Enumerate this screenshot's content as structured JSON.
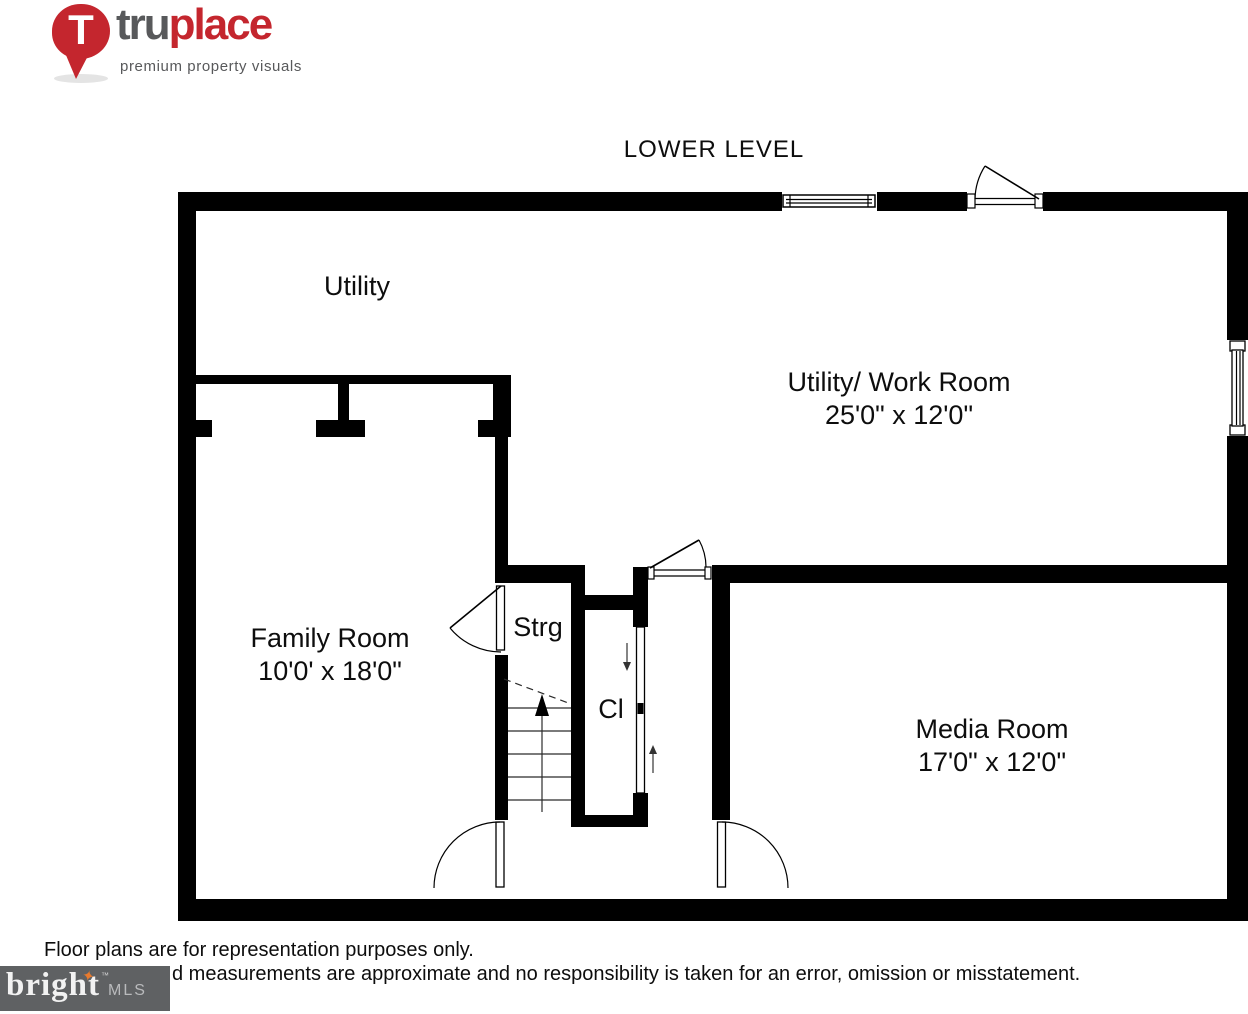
{
  "brand": {
    "pin_letter": "T",
    "name_part1": "tru",
    "name_part2": "place",
    "tagline": "premium property visuals"
  },
  "plan": {
    "title": "LOWER LEVEL",
    "rooms": {
      "utility": {
        "name": "Utility"
      },
      "utility_work": {
        "name": "Utility/ Work Room",
        "dims": "25'0\" x 12'0\""
      },
      "family": {
        "name": "Family Room",
        "dims": "10'0' x 18'0\""
      },
      "storage": {
        "name": "Strg"
      },
      "closet": {
        "name": "Cl"
      },
      "media": {
        "name": "Media Room",
        "dims": "17'0\" x 12'0\""
      }
    }
  },
  "footer": {
    "disclaimer_line1": "Floor plans are for representation purposes only.",
    "disclaimer_line2": "d measurements are approximate and no responsibility is taken for an error, omission or misstatement.",
    "mls_brand": "bright",
    "mls_tm": "™",
    "mls_suffix": "MLS"
  },
  "colors": {
    "brand_red": "#c4262e",
    "brand_gray": "#58595b",
    "mls_box_gray": "#5f6163",
    "mls_star_orange": "#e87a2e",
    "wall_black": "#000000"
  }
}
